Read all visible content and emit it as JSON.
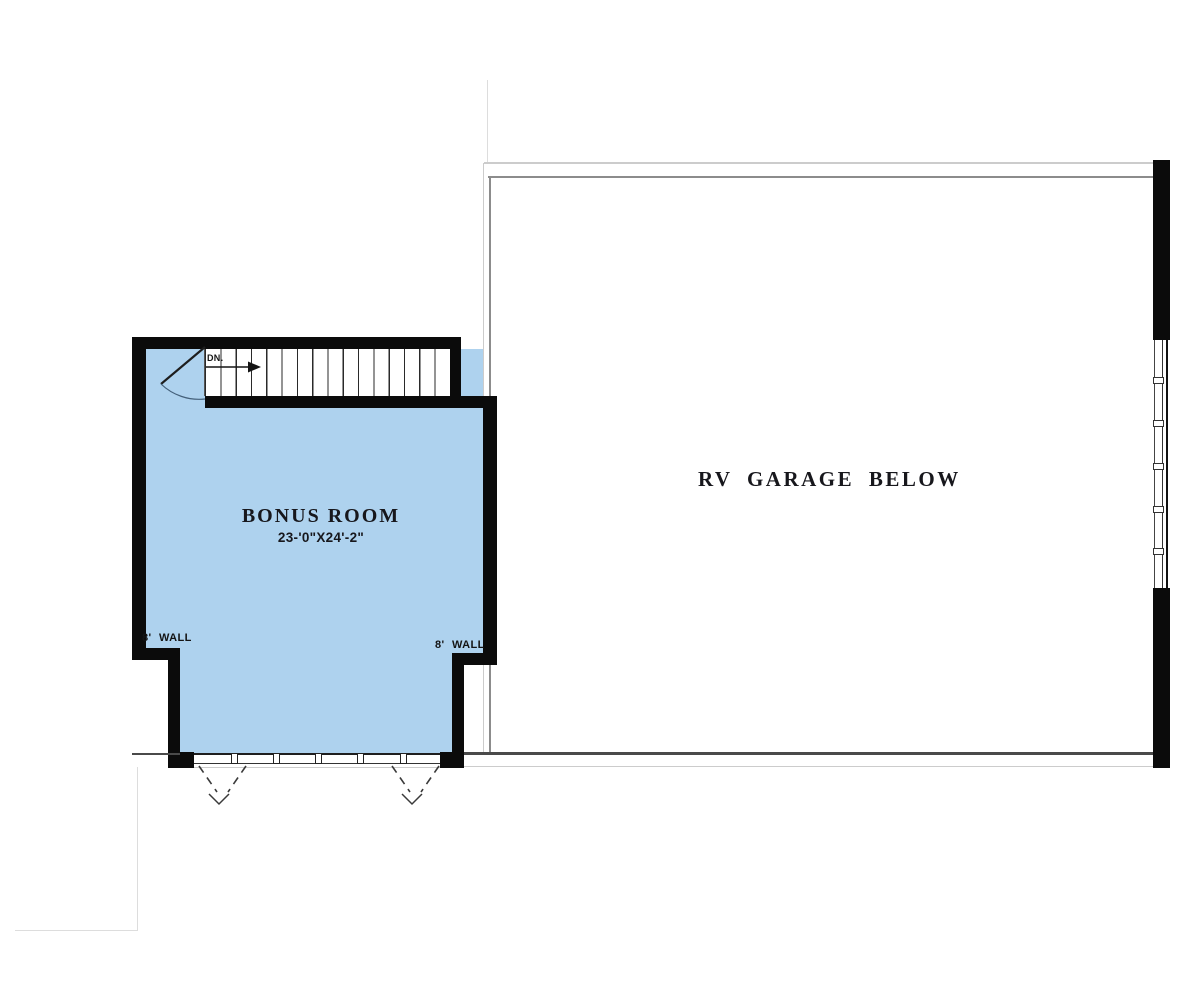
{
  "plan": {
    "bonus_room": {
      "label": "BONUS ROOM",
      "dimensions": "23-'0\"X24'-2\""
    },
    "garage": {
      "label": "RV GARAGE BELOW"
    },
    "stair": {
      "down_label": "DN."
    },
    "wall_labels": {
      "left": "8' WALL",
      "right": "8' WALL"
    },
    "colors": {
      "room_fill": "#aed2ee",
      "wall": "#0b0b0b",
      "line_mid": "#8c8c8c",
      "line_light": "#cccccc"
    }
  }
}
